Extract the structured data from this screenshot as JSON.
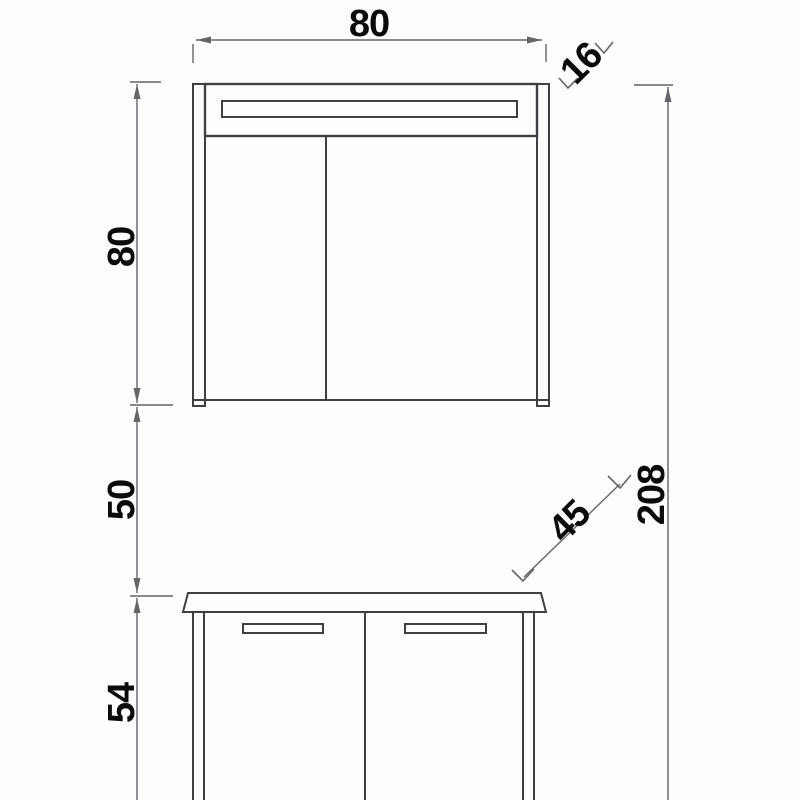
{
  "drawing": {
    "dims": {
      "cabinet_width": "80",
      "cabinet_depth": "16",
      "cabinet_height": "80",
      "wall_gap": "50",
      "vanity_depth": "45",
      "vanity_height": "54",
      "total_height": "208"
    },
    "colors": {
      "line": "#3f4044",
      "dim_line": "#63656a",
      "label": "#0b0b0b",
      "background": "#fdfdfd"
    }
  }
}
